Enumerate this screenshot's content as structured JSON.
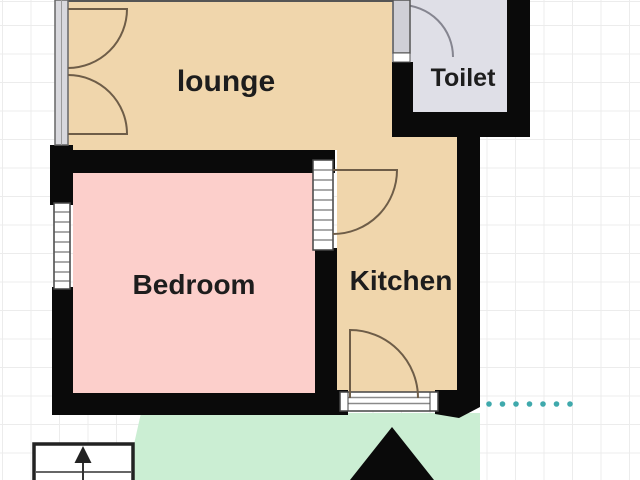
{
  "plan": {
    "rooms": [
      {
        "id": "lounge",
        "label": "lounge"
      },
      {
        "id": "toilet",
        "label": "Toilet"
      },
      {
        "id": "bedroom",
        "label": "Bedroom"
      },
      {
        "id": "kitchen",
        "label": "Kitchen"
      }
    ],
    "dotted_line_dot_count": 7
  },
  "colors": {
    "floor_lounge_kitchen": "#f0d6ac",
    "floor_bedroom": "#fccfcb",
    "floor_toilet": "#dfdfe7",
    "garden": "#cbeed3",
    "wall": "#0a0a0a",
    "door_swing": "#6e5d48",
    "toilet_door_swing": "#858590",
    "door_leaf": "#cfcfd6",
    "dotted_line": "#3fa9ac",
    "grid_line": "#ececec",
    "label_text": "#1d1d1d"
  }
}
